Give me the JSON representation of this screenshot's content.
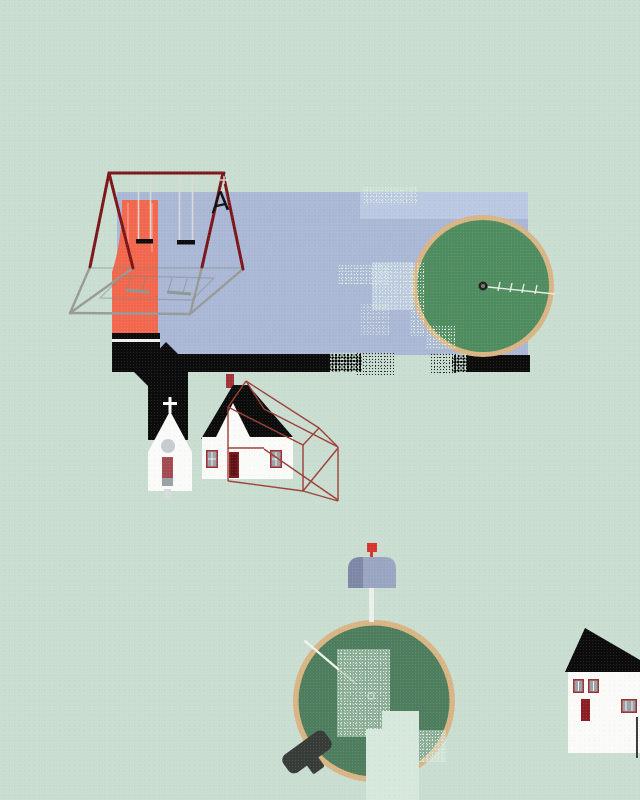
{
  "scene": {
    "description": "flat folk-art illustration: playground, church, houses and embroidery hoops on mint background",
    "swing_glyph": "A",
    "colors": {
      "bg": "#c9ddd1",
      "panel": "#aab8d5",
      "panel-light": "rgba(203,215,237,0.5)",
      "ink": "#0c0c0c",
      "orange": "#f2684e",
      "frame-red": "#7d161a",
      "shadow-gray": "#989a96",
      "seat-shadow": "#8f9693",
      "rope": "#dadcd4",
      "white": "#fafbf9",
      "hoop-rim": "#d9b485",
      "hoop-green-top": "#4f8c5f",
      "hoop-green-bottom": "#4e7e5d",
      "window-red": "#9e2f31",
      "pane-gray": "#9aa1a7",
      "door-red": "#a34b50",
      "door-gray": "#99a1a7",
      "door-dark": "#801b20",
      "door-darker": "#5f1215",
      "round-window": "#c7ccd0",
      "step-gray": "#d8dcd8",
      "wire-red": "#9c4038",
      "chimney-red": "#a23237",
      "mailbox-body": "#99a5c1",
      "mailbox-face": "#7e88a6",
      "flag-red": "#d8352a",
      "post-white": "#edefeb",
      "clamp-dark": "#383c39",
      "thread": "#e9ede8",
      "needle": "#eff3ef",
      "notch": "#d6e7dc",
      "speckle": "#dceede",
      "neighbor-door": "#8c1f24",
      "downspout": "#3a3a3a"
    },
    "objects": [
      {
        "name": "sky-panel"
      },
      {
        "name": "swing-set-frame"
      },
      {
        "name": "slide"
      },
      {
        "name": "swing-seats"
      },
      {
        "name": "playground-shadow"
      },
      {
        "name": "ground-strip"
      },
      {
        "name": "church"
      },
      {
        "name": "house"
      },
      {
        "name": "house-wireframe"
      },
      {
        "name": "embroidery-hoop-top"
      },
      {
        "name": "stitch-thread-top"
      },
      {
        "name": "mailbox"
      },
      {
        "name": "embroidery-hoop-bottom"
      },
      {
        "name": "hoop-clamp"
      },
      {
        "name": "needle-bottom"
      },
      {
        "name": "neighbor-house"
      }
    ]
  }
}
